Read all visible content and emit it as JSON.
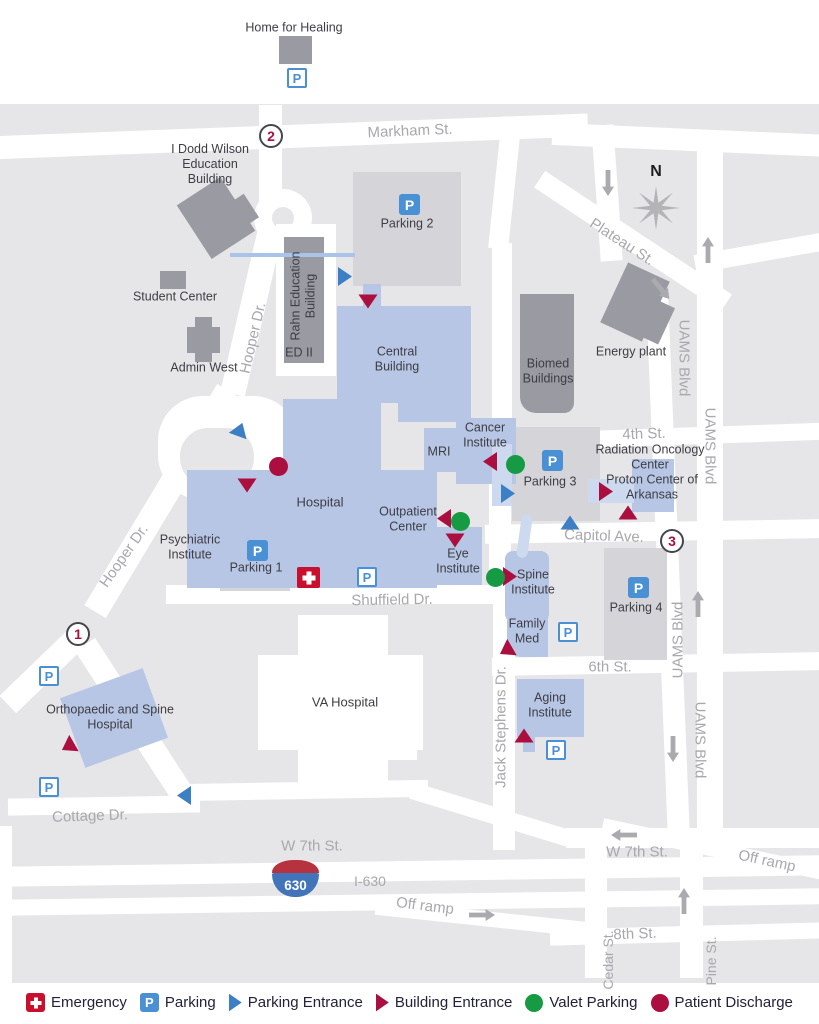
{
  "colors": {
    "map_background": "#e6e6e9",
    "street": "#ffffff",
    "uams_building_blue": "#b7c6e4",
    "generic_building_gray": "#9a9aa2",
    "parking_lot_gray": "#d4d4d9",
    "walkway_pale_blue": "#ccd9ee",
    "street_label_gray": "#a8a8ad",
    "building_label": "#3d3d45",
    "emergency_red": "#c8102e",
    "parking_blue": "#4a90d4",
    "parking_entrance_blue": "#3d7fc4",
    "building_entrance_crimson": "#ab0f3f",
    "valet_green": "#169a43",
    "patient_discharge_crimson": "#ab0f3f",
    "shield_red": "#b5323e",
    "shield_blue": "#4274ba"
  },
  "streets": {
    "markham": "Markham St.",
    "plateau": "Plateau St.",
    "hooper": "Hooper Dr.",
    "uams": "UAMS Blvd",
    "fourth": "4th St.",
    "capitol": "Capitol Ave.",
    "shuffield": "Shuffield Dr.",
    "sixth": "6th St.",
    "jack_stephens": "Jack Stephens Dr.",
    "w7th": "W 7th St.",
    "cottage": "Cottage Dr.",
    "i630": "I-630",
    "off_ramp": "Off ramp",
    "eighth": "8th St.",
    "cedar": "Cedar St.",
    "pine": "Pine St."
  },
  "buildings": {
    "home_for_healing": "Home for Healing",
    "i_dodd_wilson": "I Dodd Wilson Education Building",
    "student_center": "Student Center",
    "admin_west": "Admin West",
    "rahn": "Rahn Education Building",
    "ed_ii": "ED II",
    "central": "Central Building",
    "biomed": "Biomed Buildings",
    "energy_plant": "Energy plant",
    "mri": "MRI",
    "cancer": "Cancer Institute",
    "radiation_oncology": "Radiation Oncology Center",
    "proton": "Proton Center of Arkansas",
    "hospital": "Hospital",
    "outpatient": "Outpatient Center",
    "psychiatric": "Psychiatric Institute",
    "eye": "Eye Institute",
    "spine": "Spine Institute",
    "family_med": "Family Med",
    "aging": "Aging Institute",
    "va_hospital": "VA Hospital",
    "orthopaedic": "Orthopaedic and Spine Hospital"
  },
  "parking": {
    "p_letter": "P",
    "p1": "Parking 1",
    "p2": "Parking 2",
    "p3": "Parking 3",
    "p4": "Parking 4"
  },
  "markers": {
    "compass": "N",
    "route_1": "1",
    "route_2": "2",
    "route_3": "3",
    "shield_number": "630"
  },
  "legend": {
    "items": [
      {
        "icon": "emergency-icon",
        "label": "Emergency"
      },
      {
        "icon": "parking-icon",
        "label": "Parking"
      },
      {
        "icon": "parking-entrance-icon",
        "label": "Parking Entrance"
      },
      {
        "icon": "building-entrance-icon",
        "label": "Building Entrance"
      },
      {
        "icon": "valet-parking-icon",
        "label": "Valet Parking"
      },
      {
        "icon": "patient-discharge-icon",
        "label": "Patient Discharge"
      }
    ]
  }
}
